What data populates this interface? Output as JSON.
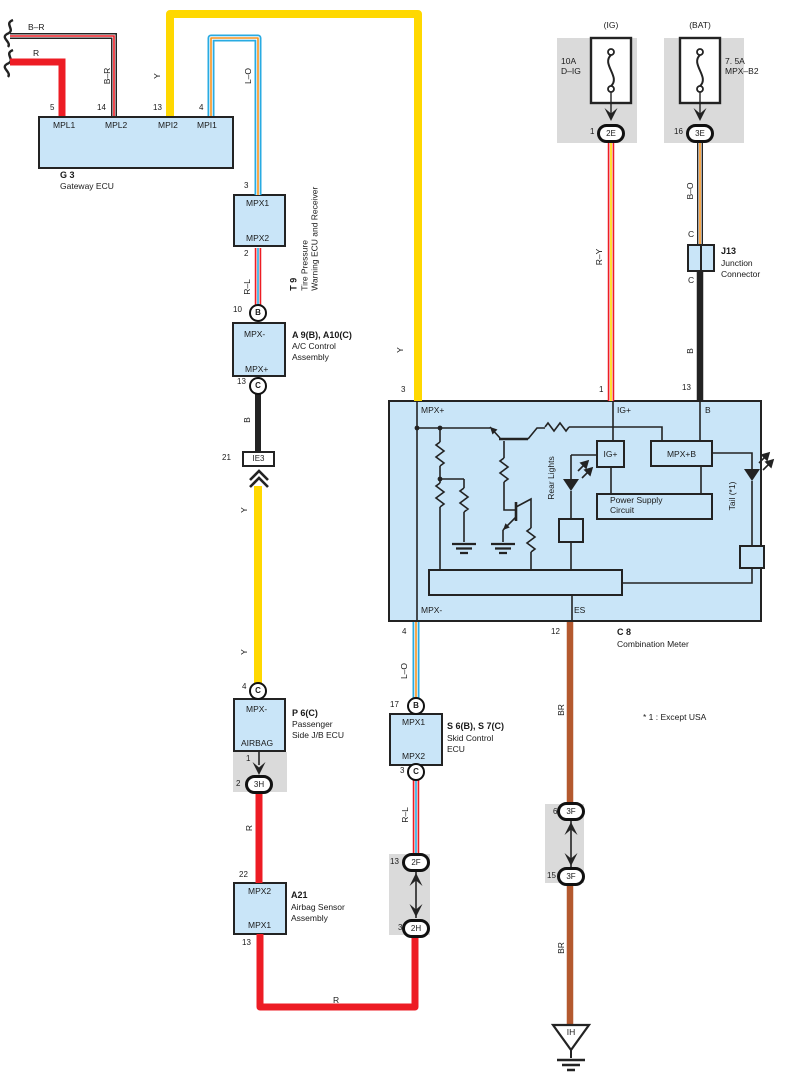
{
  "note": "* 1 : Except USA",
  "colors": {
    "yellow": "#ffd800",
    "red": "#ed1c24",
    "light_blue": "#29abe2",
    "orange": "#f6921e",
    "brown": "#b4592f",
    "black": "#232323",
    "component_fill": "#c9e5f8",
    "shield_gray": "#dadada"
  },
  "g3": {
    "num1": "5",
    "num2": "14",
    "num3": "13",
    "num4": "4",
    "pin1": "MPL1",
    "pin2": "MPL2",
    "pin3": "MPI2",
    "pin4": "MPI1",
    "id": "G 3",
    "desc": "Gateway ECU"
  },
  "t9": {
    "num_top": "3",
    "num_bot": "2",
    "pin_top": "MPX1",
    "pin_bot": "MPX2",
    "id": "T 9",
    "desc1": "Tire Pressure",
    "desc2": "Warning ECU and Receiver"
  },
  "ac": {
    "num_top": "10",
    "conn_top": "B",
    "num_bot": "13",
    "conn_bot": "C",
    "pin_top": "MPX-",
    "pin_bot": "MPX+",
    "id": "A 9(B), A10(C)",
    "desc1": "A/C Control",
    "desc2": "Assembly"
  },
  "ie3": {
    "num": "21",
    "code": "IE3"
  },
  "p6": {
    "num_top": "4",
    "conn_top": "C",
    "pin_top": "MPX-",
    "pin_bot": "AIRBAG",
    "id": "P 6(C)",
    "desc1": "Passenger",
    "desc2": "Side J/B ECU",
    "jb_num1": "1",
    "jb_num2": "2",
    "jb_conn": "3H"
  },
  "a21": {
    "num_top": "22",
    "num_bot": "13",
    "pin_top": "MPX2",
    "pin_bot": "MPX1",
    "id": "A21",
    "desc1": "Airbag Sensor",
    "desc2": "Assembly"
  },
  "skid": {
    "num_top": "17",
    "conn_top": "B",
    "num_bot": "3",
    "conn_bot": "C",
    "pin_top": "MPX1",
    "pin_bot": "MPX2",
    "id": "S 6(B), S 7(C)",
    "desc1": "Skid Control",
    "desc2": "ECU"
  },
  "c8": {
    "num_mpxp": "3",
    "num_ig": "1",
    "num_b": "13",
    "num_mpxm": "4",
    "num_es": "12",
    "pin_mpxp": "MPX+",
    "pin_ig": "IG+",
    "pin_b": "B",
    "pin_mpxm": "MPX-",
    "pin_es": "ES",
    "box_ig": "IG+",
    "box_mpxb": "MPX+B",
    "psc1": "Power Supply",
    "psc2": "Circuit",
    "led_rear": "Rear Lights",
    "led_tail": "Tail (*1)",
    "id": "C 8",
    "desc": "Combination Meter"
  },
  "fuse_ig": {
    "header": "(IG)",
    "line1": "10A",
    "line2": "D–IG",
    "num": "1",
    "conn": "2E"
  },
  "fuse_bat": {
    "header": "(BAT)",
    "line1": "7. 5A",
    "line2": "MPX–B2",
    "num": "16",
    "conn": "3E"
  },
  "j13": {
    "c_top": "C",
    "c_bot": "C",
    "id": "J13",
    "desc1": "Junction",
    "desc2": "Connector"
  },
  "conn2f": {
    "num_top": "13",
    "code_top": "2F",
    "num_bot": "3",
    "code_bot": "2H"
  },
  "conn3f": {
    "num_top": "6",
    "code_top": "3F",
    "num_bot": "15",
    "code_bot": "3F"
  },
  "ground": {
    "code": "IH"
  },
  "wires": {
    "br_h": "B–R",
    "r_h": "R",
    "br_v": "B–R",
    "y1": "Y",
    "lo1": "L–O",
    "rl1": "R–L",
    "b1": "B",
    "y2": "Y",
    "y3": "Y",
    "y4": "Y",
    "r_v": "R",
    "r_h2": "R",
    "lo2": "L–O",
    "rl2": "R–L",
    "ry": "R–Y",
    "bo": "B–O",
    "b2": "B",
    "br1": "BR",
    "br2": "BR"
  }
}
